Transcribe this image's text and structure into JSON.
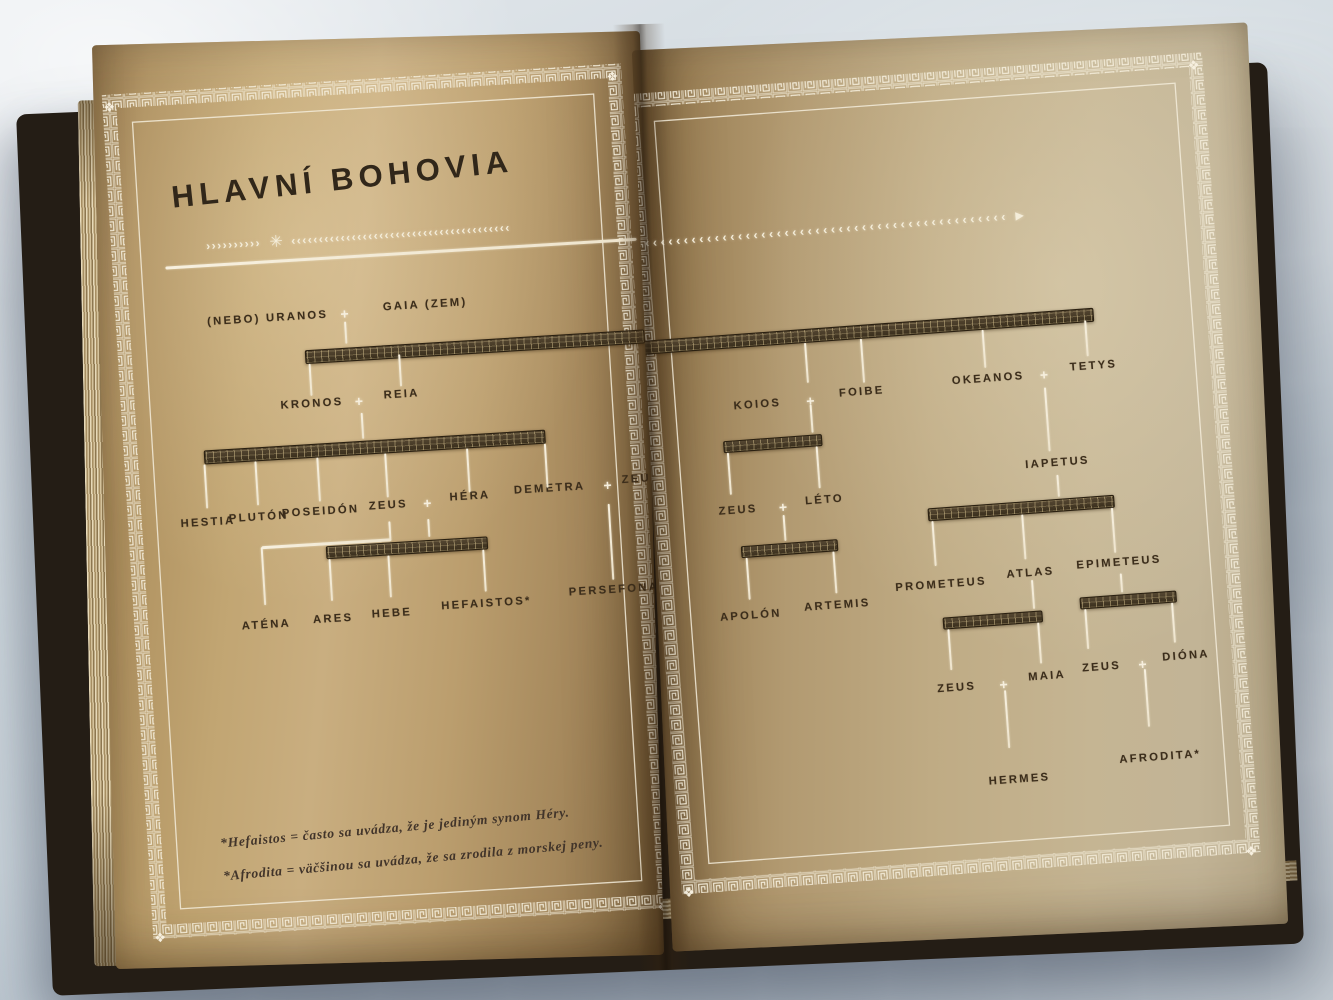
{
  "title": "HLAVNÍ BOHOVIA",
  "names": {
    "plus": "+",
    "uranos": "(NEBO) URANOS",
    "gaia": "GAIA (ZEM)",
    "kronos": "KRONOS",
    "reia": "REIA",
    "hestia": "HESTIA",
    "pluton": "PLUTÓN",
    "poseidon": "POSEIDÓN",
    "zeus": "ZEUS",
    "hera": "HÉRA",
    "demetra": "DEMETRA",
    "atena": "ATÉNA",
    "ares": "ARES",
    "hebe": "HEBE",
    "hefaistos": "HEFAISTOS*",
    "persefona": "PERSEFONA",
    "koios": "KOIOS",
    "foibe": "FOIBE",
    "okeanos": "OKEANOS",
    "tetys": "TETYS",
    "leto": "LÉTO",
    "iapetus": "IAPETUS",
    "apolon": "APOLÓN",
    "artemis": "ARTEMIS",
    "prometeus": "PROMETEUS",
    "atlas": "ATLAS",
    "epimeteus": "EPIMETEUS",
    "maia": "MAIA",
    "diona": "DIÓNA",
    "hermes": "HERMES",
    "afrodita": "AFRODITA*"
  },
  "relations": [
    {
      "union": "URANOS + GAIA",
      "children": [
        "KRONOS",
        "REIA",
        "KOIOS",
        "FOIBE",
        "OKEANOS",
        "TETYS"
      ]
    },
    {
      "union": "KRONOS + REIA",
      "children": [
        "HESTIA",
        "PLUTÓN",
        "POSEIDÓN",
        "ZEUS",
        "HÉRA",
        "DEMETRA"
      ]
    },
    {
      "union": "ZEUS + HÉRA",
      "children": [
        "ARES",
        "HEBE",
        "HEFAISTOS*"
      ]
    },
    {
      "union": "ZEUS",
      "children": [
        "ATÉNA"
      ]
    },
    {
      "union": "DEMETRA + ZEUS",
      "children": [
        "PERSEFONA"
      ]
    },
    {
      "union": "KOIOS + FOIBE",
      "children": [
        "LÉTO"
      ]
    },
    {
      "union": "ZEUS + LÉTO",
      "children": [
        "APOLÓN",
        "ARTEMIS"
      ]
    },
    {
      "union": "OKEANOS + TETYS",
      "children": [
        "IAPETUS"
      ]
    },
    {
      "union": "IAPETUS",
      "children": [
        "PROMETEUS",
        "ATLAS",
        "EPIMETEUS"
      ]
    },
    {
      "union": "ZEUS + MAIA",
      "children": [
        "HERMES"
      ]
    },
    {
      "union": "ZEUS + DIÓNA",
      "children": [
        "AFRODITA*"
      ]
    }
  ],
  "footnotes": {
    "hefaistos": "*Hefaistos = často sa uvádza, že je jediným synom Héry.",
    "afrodita": "*Afrodita = väčšinou sa uvádza, že sa zrodila z morskej peny."
  },
  "ornament": {
    "left_chevrons": "››››››››››",
    "flower": "✳",
    "right_chevrons": "‹‹‹‹‹‹‹‹‹‹‹‹‹‹‹‹‹‹‹‹‹‹‹‹‹‹‹‹‹‹‹‹‹‹‹‹‹‹‹‹",
    "right_page_chevrons": "‹‹‹‹‹‹‹‹‹‹‹‹‹‹‹‹‹‹‹‹‹‹‹‹‹‹‹‹‹‹‹‹‹‹‹‹‹‹‹‹‹‹‹‹‹‹‹‹",
    "arrowhead": "▶",
    "corner_motif": "❖"
  },
  "colors": {
    "page_tan": "#bd9f70",
    "ink_brown": "#3b2d1b",
    "foil_white": "#f5eedc",
    "fabric_blue_grey": "#ccd6dd",
    "cover_dark": "#241d15"
  }
}
